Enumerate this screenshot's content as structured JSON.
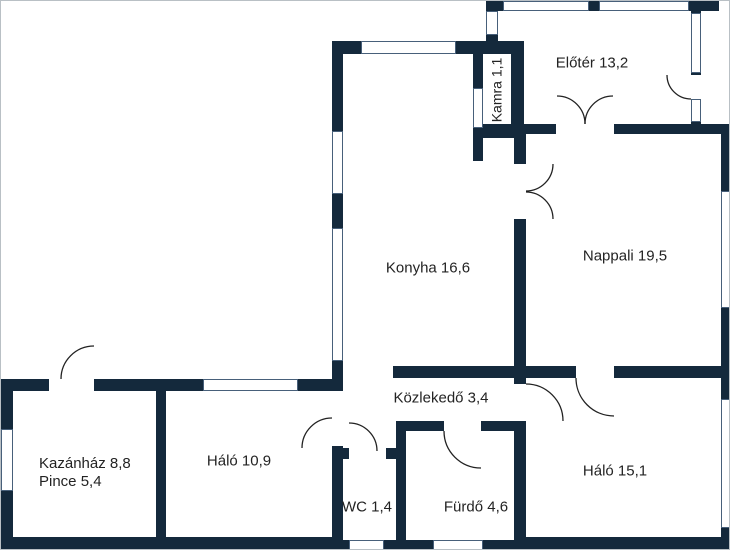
{
  "plan": {
    "rooms": {
      "eloter": {
        "label": "Előtér 13,2"
      },
      "kamra": {
        "label": "Kamra 1,1"
      },
      "konyha": {
        "label": "Konyha 16,6"
      },
      "nappali": {
        "label": "Nappali 19,5"
      },
      "kozlekedo": {
        "label": "Közlekedő 3,4"
      },
      "halo_kicsi": {
        "label": "Háló 10,9"
      },
      "kazanhaz": {
        "label": "Kazánház 8,8"
      },
      "pince": {
        "label": "Pince 5,4"
      },
      "wc": {
        "label": "WC 1,4"
      },
      "furdo": {
        "label": "Fürdő 4,6"
      },
      "halo_nagy": {
        "label": "Háló 15,1"
      }
    },
    "colors": {
      "wall": "#14293c",
      "floor": "#ffffff",
      "window_border": "#48607a",
      "text": "#232323",
      "arc": "#222222"
    }
  }
}
